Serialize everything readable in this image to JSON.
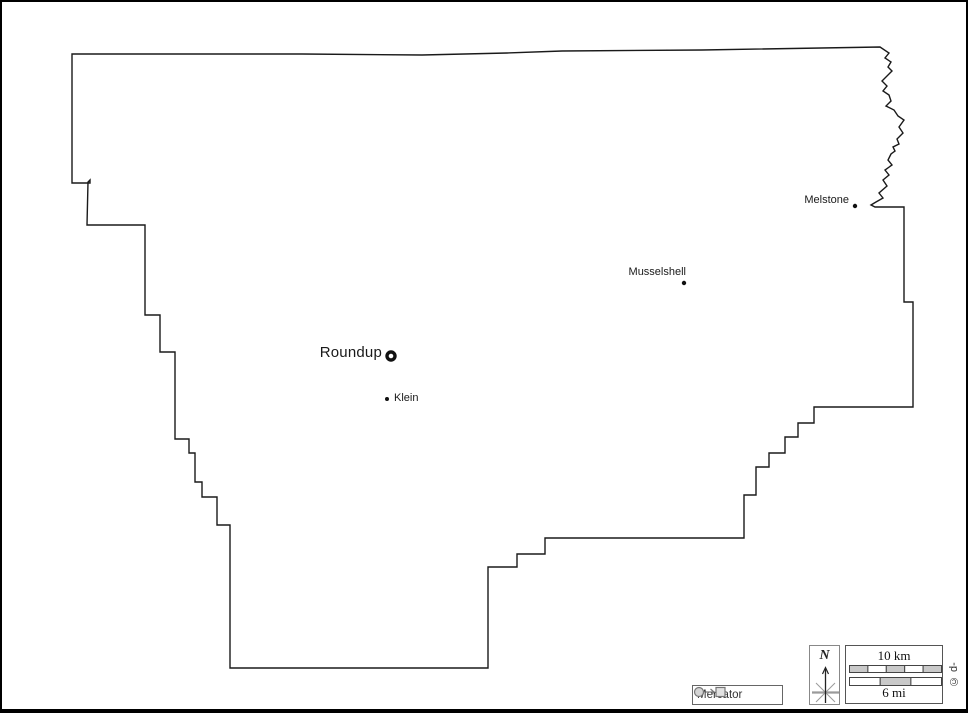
{
  "towns": [
    {
      "name": "Roundup",
      "marker": "ring-county-seat"
    },
    {
      "name": "Klein",
      "marker": "dot"
    },
    {
      "name": "Musselshell",
      "marker": "dot"
    },
    {
      "name": "Melstone",
      "marker": "dot"
    }
  ],
  "projection_badge": {
    "label": "Mercator",
    "icon": "circle-to-square-icon"
  },
  "compass": {
    "north_label": "N",
    "icon": "compass-rose-icon"
  },
  "scale": {
    "km_label": "10 km",
    "mi_label": "6 mi"
  },
  "credit": "© d-maps.com",
  "colors": {
    "outline": "#1a1a1a",
    "label_text": "#1a1a1a",
    "muted_gray": "#999999",
    "scale_fill": "#c9c9c9",
    "box_border": "#555555"
  }
}
